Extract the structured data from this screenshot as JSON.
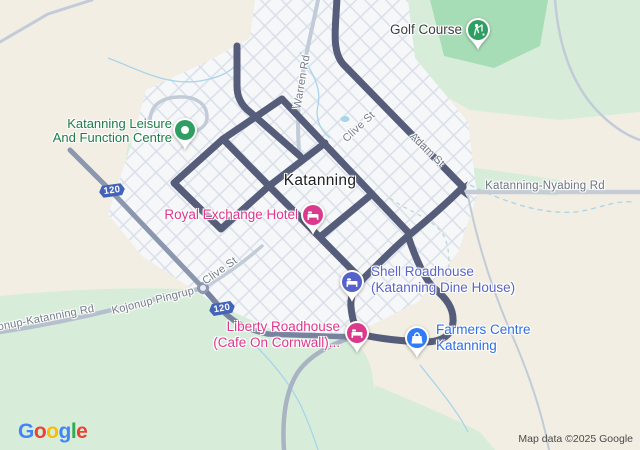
{
  "map": {
    "city": {
      "label": "Katanning"
    },
    "pois": [
      {
        "name": "golf-course",
        "lines": [
          "Golf Course"
        ],
        "text_color": "#3d4043",
        "pin_color": "#2f9e63",
        "icon": "golf-flag"
      },
      {
        "name": "katanning-leisure-and-function-centre",
        "lines": [
          "Katanning Leisure",
          "And Function Centre"
        ],
        "text_color": "#1d7d4b",
        "pin_color": "#2f9e63",
        "icon": "place-dot"
      },
      {
        "name": "royal-exchange-hotel",
        "lines": [
          "Royal Exchange Hotel"
        ],
        "text_color": "#e0368c",
        "pin_color": "#d93a8c",
        "icon": "bed"
      },
      {
        "name": "shell-roadhouse",
        "lines": [
          "Shell Roadhouse",
          "(Katanning Dine House)"
        ],
        "text_color": "#5a64c9",
        "pin_color": "#5661c9",
        "icon": "bed"
      },
      {
        "name": "liberty-roadhouse",
        "lines": [
          "Liberty Roadhouse",
          "(Cafe On Cornwall)..."
        ],
        "text_color": "#e0368c",
        "pin_color": "#d93a8c",
        "icon": "bed"
      },
      {
        "name": "farmers-centre-katanning",
        "lines": [
          "Farmers Centre",
          "Katanning"
        ],
        "text_color": "#2f6fe4",
        "pin_color": "#2f7cf6",
        "icon": "shopping-bag"
      }
    ],
    "road_labels": [
      {
        "text": "Warren Rd"
      },
      {
        "text": "Clive St"
      },
      {
        "text": "Adam St"
      },
      {
        "text": "Katanning-Nyabing Rd"
      },
      {
        "text": "Clive St"
      },
      {
        "text": "Kojonup Pingrup"
      },
      {
        "text": "onup-Katanning Rd"
      }
    ],
    "route_shields": [
      {
        "number": "120"
      },
      {
        "number": "120"
      }
    ],
    "colors": {
      "background": "#f2eee3",
      "urban_fill": "#f6f7f9",
      "grid_line": "#d9dfe9",
      "park_light": "#d7edda",
      "park_medium": "#a7ddb6",
      "park_dark": "#8ad2a2",
      "water": "#a9d4ea",
      "road_dark": "#555d7a",
      "road_medium": "#8b96af",
      "road_light": "#c2cbd8",
      "shield_blue": "#4263b8"
    },
    "footer": {
      "attribution": "Map data ©2025 Google",
      "logo": {
        "text": "Google",
        "letters": [
          {
            "ch": "G",
            "color": "#4285F4"
          },
          {
            "ch": "o",
            "color": "#EA4335"
          },
          {
            "ch": "o",
            "color": "#FBBC05"
          },
          {
            "ch": "g",
            "color": "#4285F4"
          },
          {
            "ch": "l",
            "color": "#34A853"
          },
          {
            "ch": "e",
            "color": "#EA4335"
          }
        ]
      }
    }
  }
}
